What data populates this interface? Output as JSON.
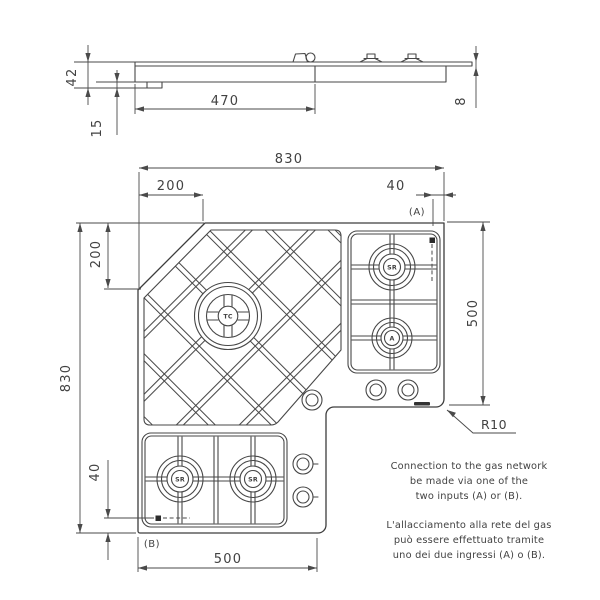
{
  "side_view": {
    "dim_total_height": "42",
    "dim_tab_height": "15",
    "dim_body_width": "470",
    "dim_edge_thickness": "8"
  },
  "top_view": {
    "dim_total_width": "830",
    "dim_chamfer_top": "200",
    "dim_input_a_offset": "40",
    "input_a_label": "(A)",
    "dim_right_depth": "500",
    "dim_total_depth": "830",
    "dim_chamfer_left": "200",
    "dim_input_b_offset": "40",
    "input_b_label": "(B)",
    "dim_bottom_width": "500",
    "corner_radius_label": "R10",
    "burners": {
      "center": "TC",
      "right_top": "SR",
      "right_bottom": "A",
      "bottom_left": "SR",
      "bottom_right": "SR"
    }
  },
  "notes": {
    "en": [
      "Connection to the gas network",
      "be made via one of the",
      "two inputs (A) or (B)."
    ],
    "it": [
      "L'allacciamento alla rete del gas",
      "può essere effettuato tramite",
      "uno dei due ingressi (A) o (B)."
    ]
  },
  "colors": {
    "line": "#404040",
    "background": "#ffffff"
  }
}
